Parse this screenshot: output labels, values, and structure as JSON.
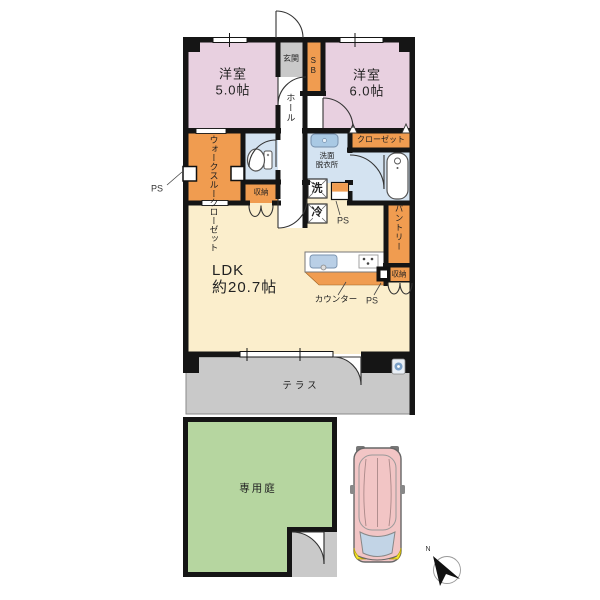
{
  "floor_plan": {
    "rooms": {
      "bedroom_left": {
        "label": "洋室\n5.0帖"
      },
      "bedroom_right": {
        "label": "洋室\n6.0帖"
      },
      "entrance": {
        "label": "玄関"
      },
      "shoe_box": {
        "label": "SB"
      },
      "hall": {
        "label": "ホール"
      },
      "walk_through_closet": {
        "label": "ウォークスルークローゼット"
      },
      "toilet_storage": {
        "label": "収納"
      },
      "washroom": {
        "label": "洗面\n脱衣所"
      },
      "washing_machine": {
        "label": "洗"
      },
      "refrigerator": {
        "label": "冷"
      },
      "closet": {
        "label": "クローゼット"
      },
      "pantry": {
        "label": "パントリー"
      },
      "kitchen_storage": {
        "label": "収納"
      },
      "ldk": {
        "label": "LDK\n約20.7帖"
      },
      "counter": {
        "label": "カウンター"
      },
      "terrace": {
        "label": "テラス"
      },
      "private_garden": {
        "label": "専用庭"
      }
    },
    "annotations": {
      "ps_left": "PS",
      "ps_middle": "PS",
      "ps_kitchen": "PS",
      "north": "N"
    },
    "colors": {
      "wall": "#151515",
      "bedroom_pink": "#e8d0e0",
      "closet_orange": "#f09c50",
      "wet_area_blue": "#d4e3f1",
      "ldk_cream": "#fbeecc",
      "entrance_gray": "#c9c9c9",
      "terrace_gray": "#c9c9c9",
      "garden_green": "#b6d6a0",
      "car_body": "#f2c5c5",
      "car_glass": "#c2d4e6",
      "car_light": "#f5e733"
    }
  }
}
